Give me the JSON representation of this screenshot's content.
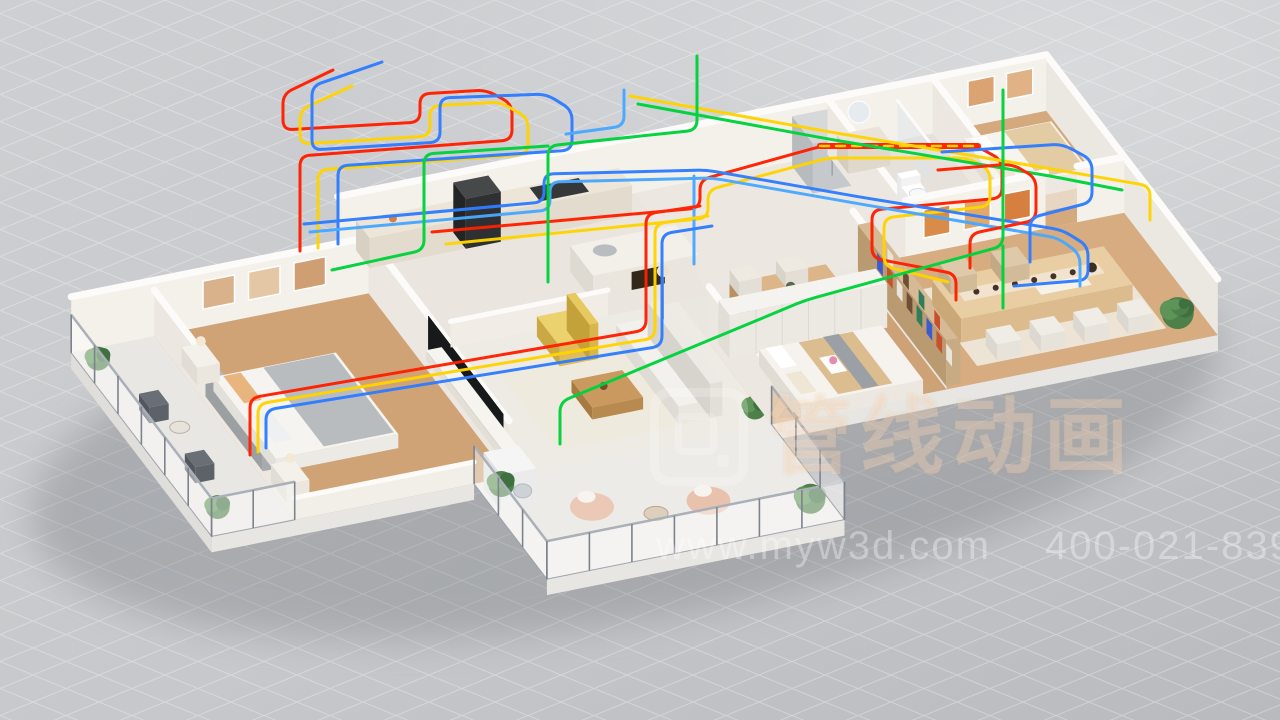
{
  "watermark": {
    "brand_text": "管线动画",
    "url": "www.myw3d.com",
    "phone": "400-021-8398"
  },
  "palette": {
    "backdrop": "#c8cacc",
    "grid_line": "#ffffff",
    "wall_face_south": "#f4f1ea",
    "wall_face_east": "#ece8e1",
    "wall_top": "#fcfbf9",
    "wood_floor": "#cfa376",
    "marble_floor": "#eeebe5",
    "pipes": {
      "red": "#ff2000",
      "yellow": "#ffd400",
      "blue": "#2f7dff",
      "sky": "#49a8ff",
      "green": "#00d23c"
    }
  }
}
